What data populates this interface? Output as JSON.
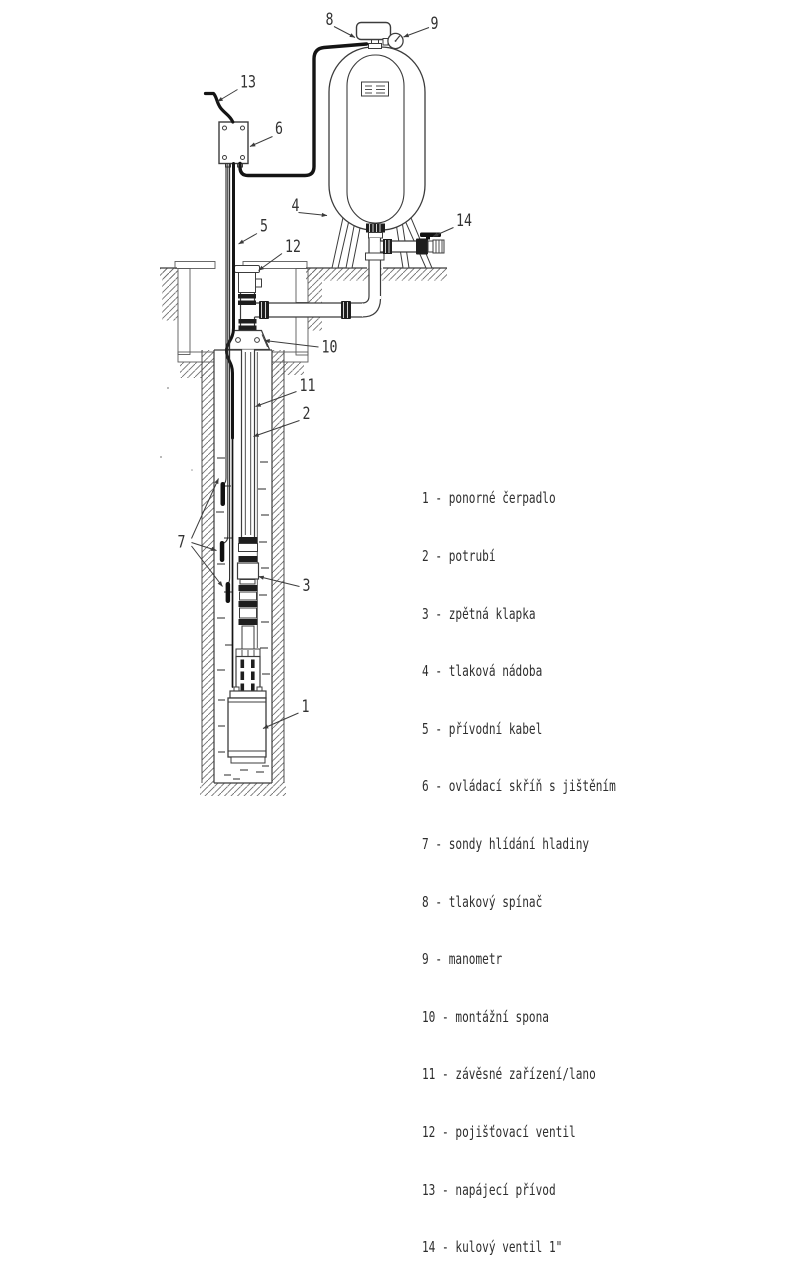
{
  "diagram_title": "Submersible pump installation diagram",
  "callouts": {
    "pump": "1",
    "pipe": "2",
    "check_valve": "3",
    "tank": "4",
    "supply_cable": "5",
    "control_box": "6",
    "probes": "7",
    "pressure_switch": "8",
    "manometer": "9",
    "clamp": "10",
    "rope": "11",
    "safety_valve": "12",
    "power_feed": "13",
    "ball_valve": "14"
  },
  "legend": {
    "items": [
      "1 - ponorné čerpadlo",
      "2 - potrubí",
      "3 - zpětná klapka",
      "4 - tlaková nádoba",
      "5 - přívodní kabel",
      "6 - ovládací skříň s jištěním",
      "7 - sondy hlídání hladiny",
      "8 - tlakový spínač",
      "9 - manometr",
      "10 - montážní spona",
      "11 - závěsné zařízení/lano",
      "12 - pojišťovací ventil",
      "13 - napájecí přívod",
      "14 - kulový ventil 1\""
    ]
  },
  "colors": {
    "line": "#3c3c3c",
    "cable": "#141414",
    "concrete": "#c7c7c7",
    "text": "#2e2e2e"
  }
}
